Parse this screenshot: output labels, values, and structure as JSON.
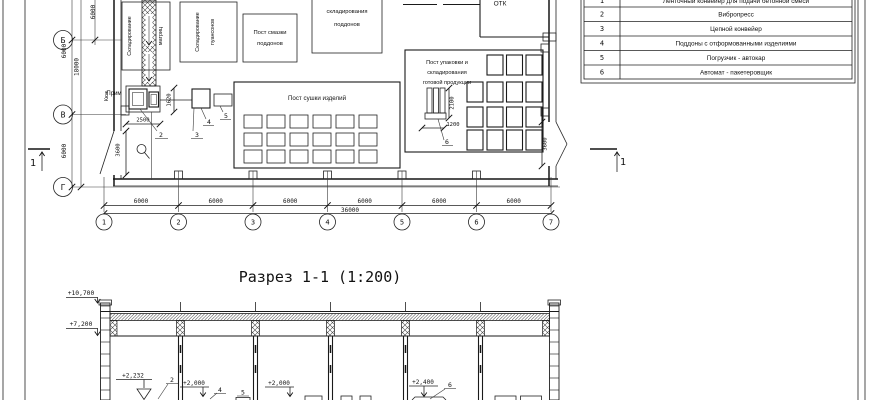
{
  "plan": {
    "rows": [
      "Б",
      "В",
      "Г"
    ],
    "cols": [
      "1",
      "2",
      "3",
      "4",
      "5",
      "6",
      "7"
    ],
    "dim_bay": "6000",
    "dim_total_w": "36000",
    "dim_total_h": "18000",
    "dim_press_w": "2500",
    "dim_press_h": "1620",
    "dim_door": "3600",
    "dim_pack_h": "2100",
    "dim_pack_w": "1200",
    "label_storage_matrix_1": "Складирование",
    "label_storage_matrix_2": "матриц",
    "label_storage_punch_1": "Складирование",
    "label_storage_punch_2": "пуансонов",
    "label_grease_1": "Пост смазки",
    "label_grease_2": "поддонов",
    "label_pallets_1": "складирования",
    "label_pallets_2": "поддонов",
    "label_otk": "ОТК",
    "label_drying": "Пост сушки изделий",
    "label_packing_1": "Пост упаковки и",
    "label_packing_2": "складирования",
    "label_packing_3": "готовой продукции",
    "label_pit": "Прим",
    "label_wall_note": "Кюж",
    "callout_2": "2",
    "callout_3": "3",
    "callout_4": "4",
    "callout_5": "5",
    "callout_6": "6",
    "section_mark": "1"
  },
  "legend": {
    "rows": [
      {
        "num": "1",
        "label": "Ленточный конвейер для подачи бетонной смеси"
      },
      {
        "num": "2",
        "label": "Вибропресс"
      },
      {
        "num": "3",
        "label": "Цепной конвейер"
      },
      {
        "num": "4",
        "label": "Поддоны с отформованными изделиями"
      },
      {
        "num": "5",
        "label": "Погрузчик - автокар"
      },
      {
        "num": "6",
        "label": "Автомат - пакетеровщик"
      }
    ]
  },
  "section": {
    "title": "Разрез 1-1 (1:200)",
    "elev_roof_top": "+10,700",
    "elev_roof_bottom": "+7,200",
    "elev_press": "+2,232",
    "elev_2000": "+2,000",
    "elev_2400": "+2,400",
    "callout_2": "2",
    "callout_4": "4",
    "callout_5": "5",
    "callout_6": "6"
  }
}
